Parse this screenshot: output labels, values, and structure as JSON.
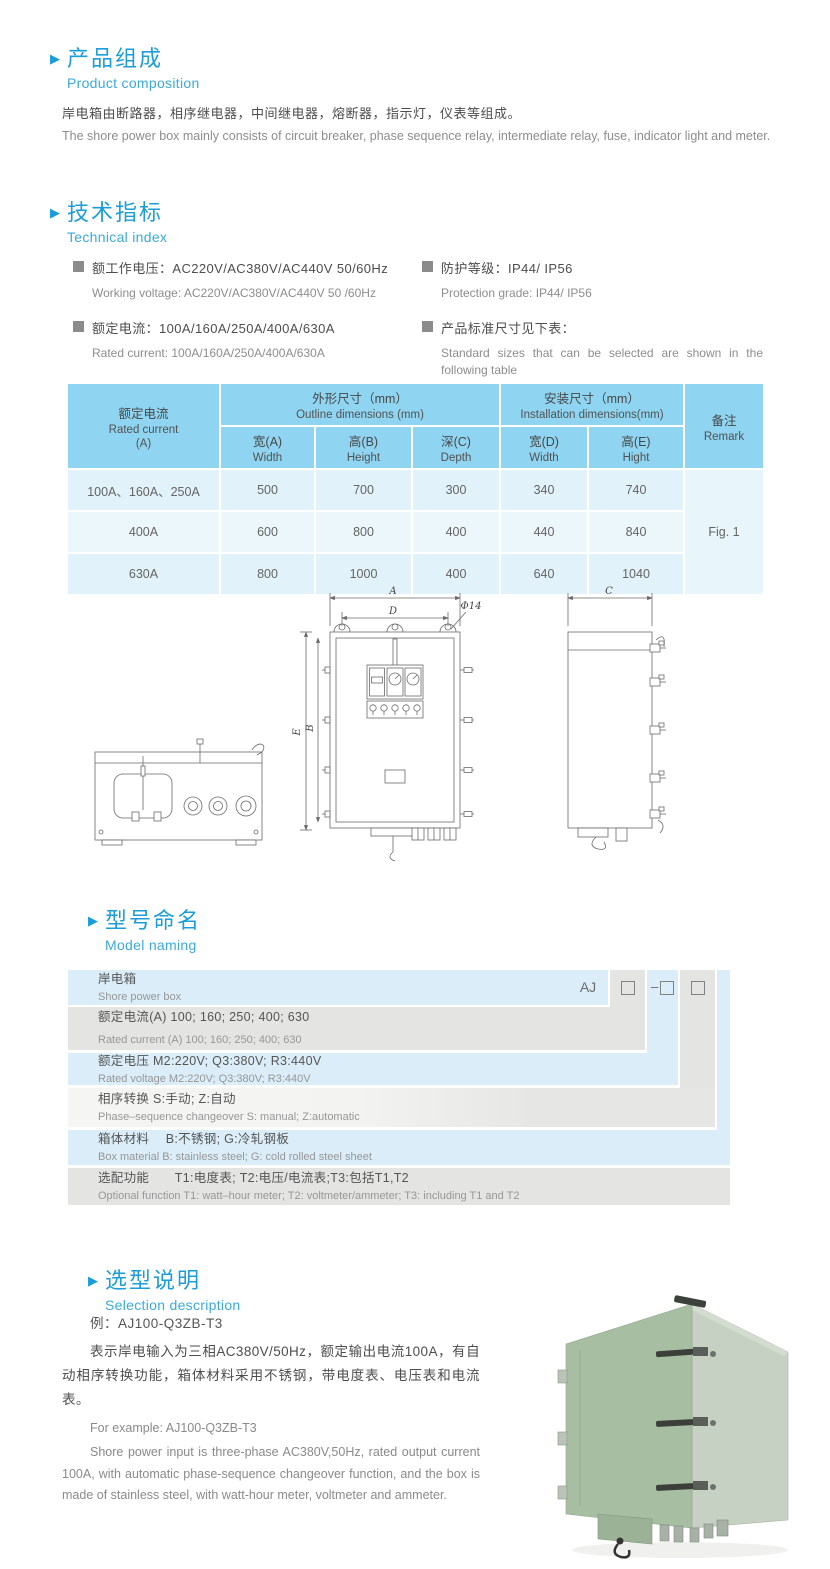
{
  "product": {
    "title_cn": "产品组成",
    "title_en": "Product  composition",
    "body_cn": "岸电箱由断路器，相序继电器，中间继电器，熔断器，指示灯，仪表等组成。",
    "body_en": "The shore power box mainly consists of circuit breaker, phase sequence relay, intermediate relay, fuse, indicator light and meter."
  },
  "technical": {
    "title_cn": "技术指标",
    "title_en": "Technical index",
    "bullets_left": [
      {
        "cn": "额工作电压：AC220V/AC380V/AC440V  50/60Hz",
        "en": "Working voltage: AC220V/AC380V/AC440V 50 /60Hz"
      },
      {
        "cn": "额定电流：100A/160A/250A/400A/630A",
        "en": "Rated current: 100A/160A/250A/400A/630A"
      }
    ],
    "bullets_right": [
      {
        "cn": "防护等级：IP44/ IP56",
        "en": "Protection grade: IP44/ IP56"
      },
      {
        "cn": "产品标准尺寸见下表：",
        "en": "Standard sizes that can be selected are shown in the following table"
      }
    ]
  },
  "size_table": {
    "h_current_cn": "额定电流",
    "h_current_en": "Rated current",
    "h_current_unit": "(A)",
    "h_outline_cn": "外形尺寸（mm）",
    "h_outline_en": "Outline dimensions (mm)",
    "h_install_cn": "安装尺寸（mm）",
    "h_install_en": "Installation dimensions(mm)",
    "h_remark_cn": "备注",
    "h_remark_en": "Remark",
    "sub": [
      {
        "cn": "宽(A)",
        "en": "Width"
      },
      {
        "cn": "高(B)",
        "en": "Height"
      },
      {
        "cn": "深(C)",
        "en": "Depth"
      },
      {
        "cn": "宽(D)",
        "en": "Width"
      },
      {
        "cn": "高(E)",
        "en": "Hight"
      }
    ],
    "rows": [
      {
        "current": "100A、160A、250A",
        "values": [
          "500",
          "700",
          "300",
          "340",
          "740"
        ]
      },
      {
        "current": "400A",
        "values": [
          "600",
          "800",
          "400",
          "440",
          "840"
        ]
      },
      {
        "current": "630A",
        "values": [
          "800",
          "1000",
          "400",
          "640",
          "1040"
        ]
      }
    ],
    "remark": "Fig. 1"
  },
  "drawing": {
    "dim_a": "A",
    "dim_d": "D",
    "dim_phi": "Φ14",
    "dim_e": "E",
    "dim_b": "B",
    "dim_c": "C"
  },
  "model": {
    "title_cn": "型号命名",
    "title_en": "Model naming",
    "code_prefix": "AJ",
    "code_dash": "–",
    "rows": [
      {
        "cn": "岸电箱",
        "en": "Shore power box"
      },
      {
        "cn": "额定电流(A)  100; 160; 250; 400; 630",
        "en": "Rated current (A) 100; 160; 250; 400; 630"
      },
      {
        "cn": "额定电压   M2:220V;  Q3:380V;  R3:440V",
        "en": "Rated voltage  M2:220V;  Q3:380V;  R3:440V"
      },
      {
        "cn": "相序转换  S:手动; Z:自动",
        "en": "Phase–sequence changeover  S: manual;  Z:automatic"
      },
      {
        "cn": "箱体材料　 B:不锈钢;  G:冷轧钢板",
        "en": "Box material   B: stainless steel; G: cold rolled steel sheet"
      },
      {
        "cn": "选配功能　　T1:电度表;  T2:电压/电流表;T3:包括T1,T2",
        "en": "Optional function  T1: watt–hour meter; T2: voltmeter/ammeter; T3: including T1 and T2"
      }
    ]
  },
  "selection": {
    "title_cn": "选型说明",
    "title_en": "Selection description",
    "example_cn": "例：AJ100-Q3ZB-T3",
    "body_cn": "表示岸电输入为三相AC380V/50Hz，额定输出电流100A，有自动相序转换功能，箱体材料采用不锈钢，带电度表、电压表和电流表。",
    "example_en": "For example: AJ100-Q3ZB-T3",
    "body_en": "Shore power input is three-phase AC380V,50Hz, rated output current 100A, with automatic phase-sequence changeover function, and the box is made of stainless steel, with watt-hour meter, voltmeter and ammeter."
  }
}
